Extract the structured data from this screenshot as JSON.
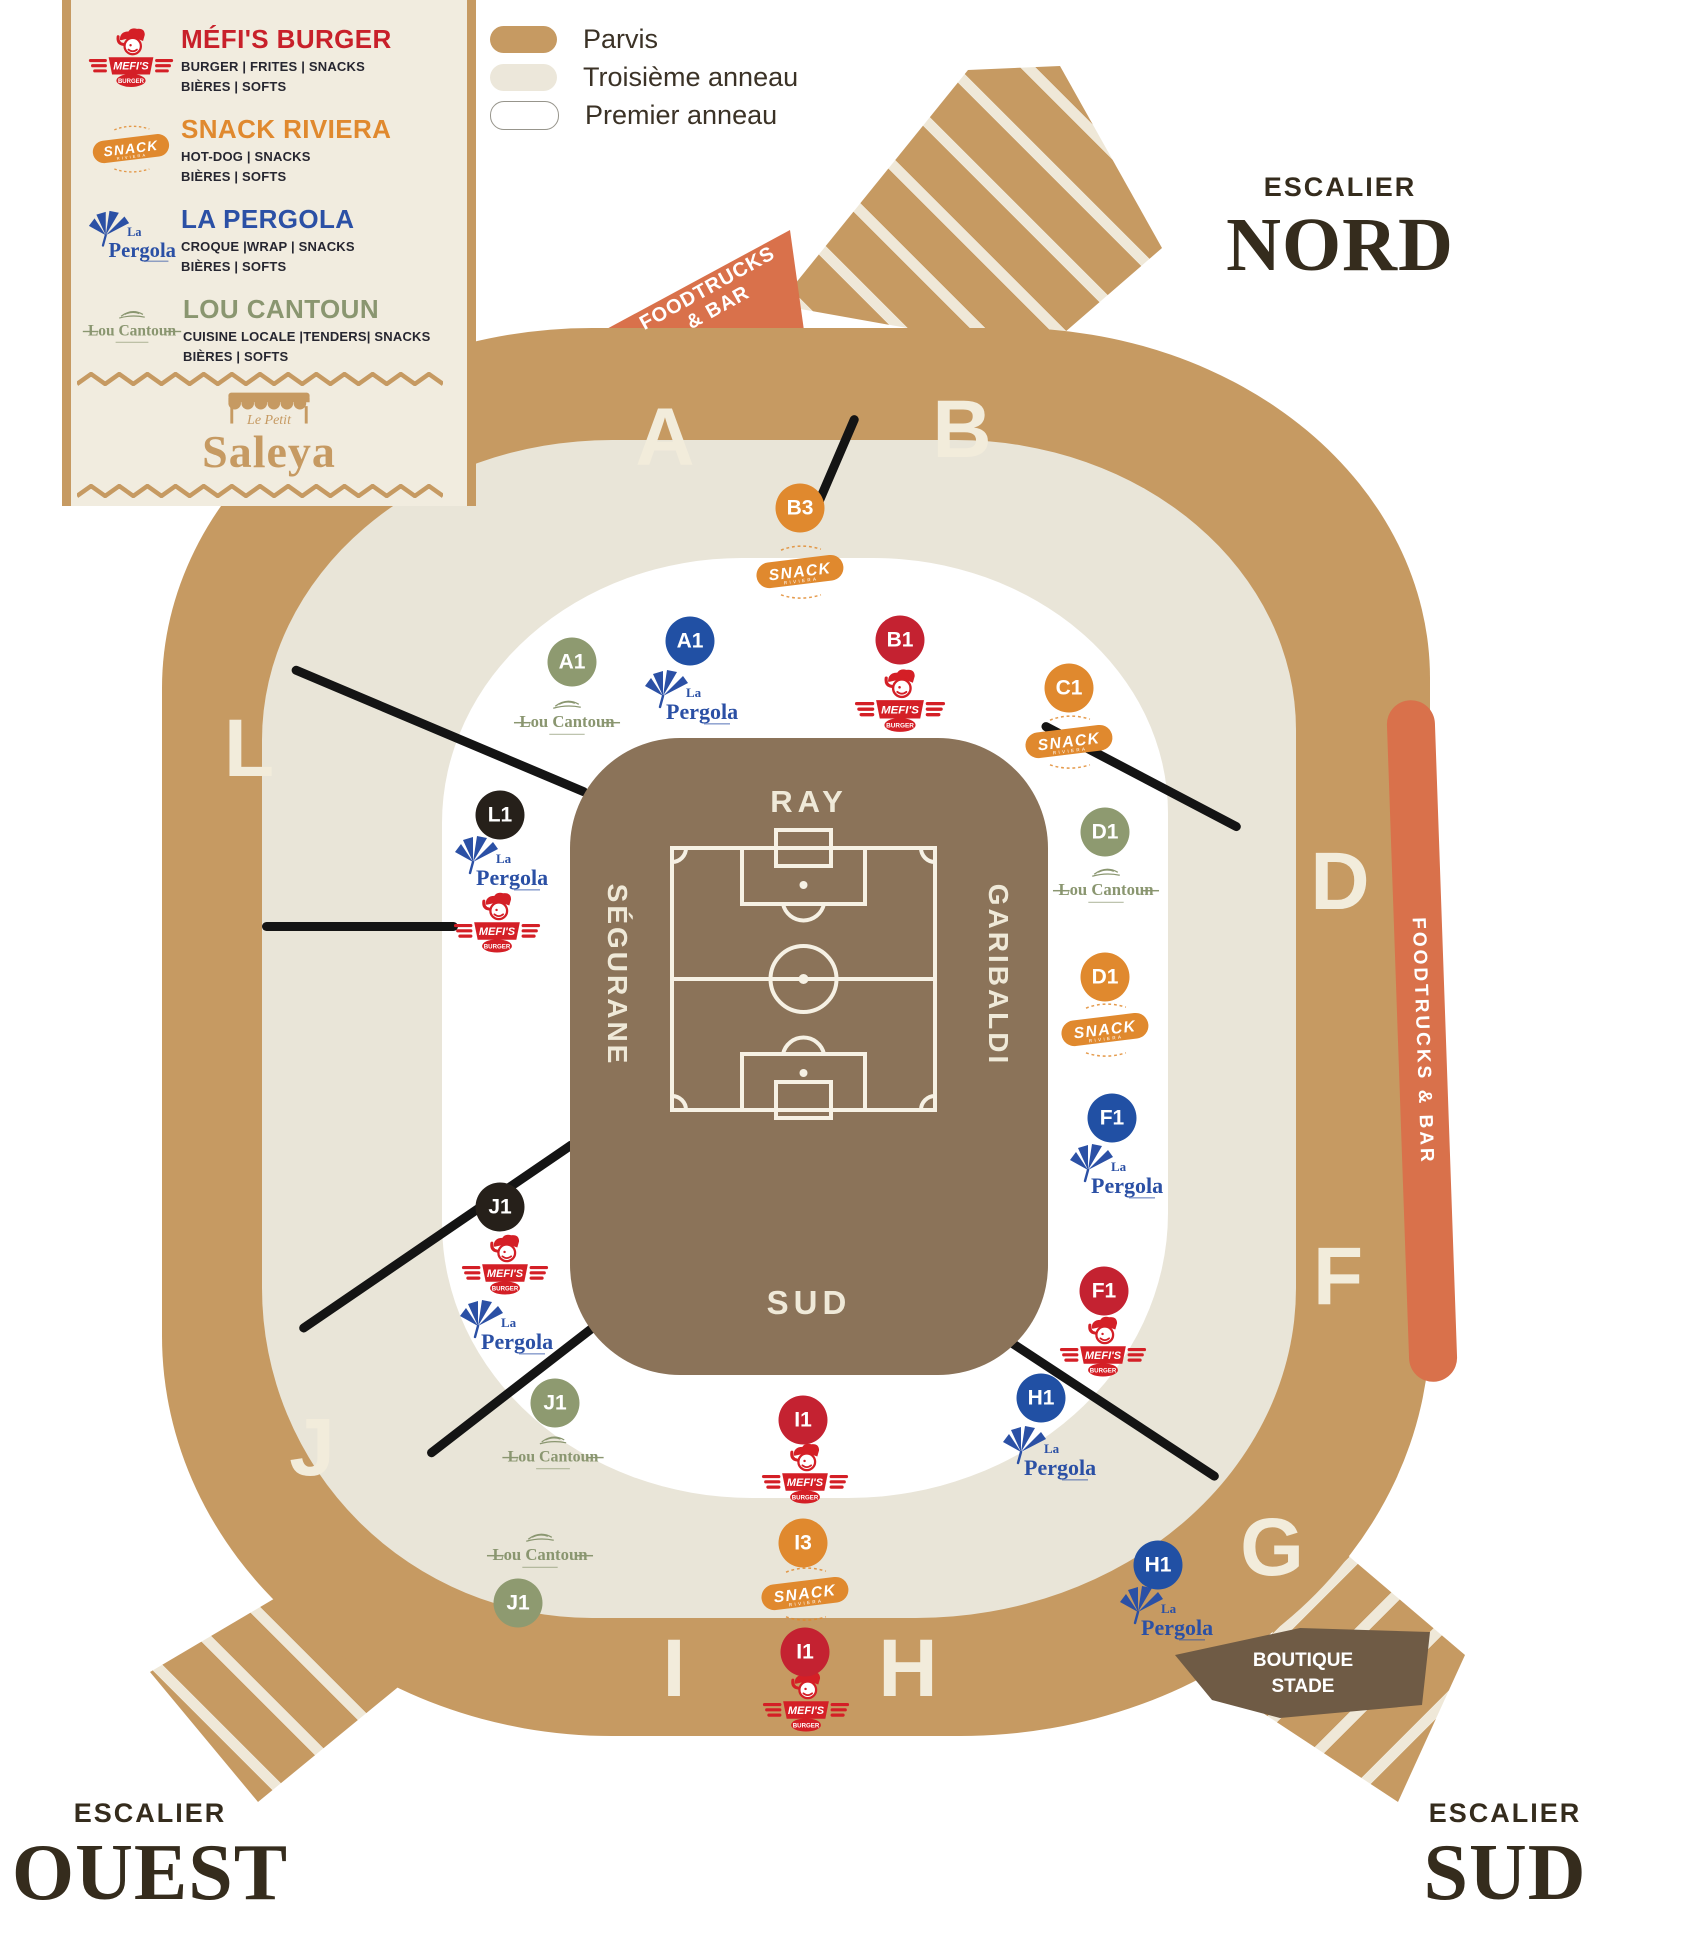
{
  "legend": {
    "vendors": [
      {
        "id": "mefis",
        "name": "MÉFI'S BURGER",
        "line1": "BURGER | FRITES | SNACKS",
        "line2": "BIÈRES | SOFTS",
        "color": "#c8202a"
      },
      {
        "id": "snack",
        "name": "SNACK RIVIERA",
        "line1": "HOT-DOG | SNACKS",
        "line2": "BIÈRES | SOFTS",
        "color": "#e0892e"
      },
      {
        "id": "pergola",
        "name": "LA PERGOLA",
        "line1": "CROQUE |WRAP | SNACKS",
        "line2": "BIÈRES | SOFTS",
        "color": "#2b50a5"
      },
      {
        "id": "loucantoun",
        "name": "LOU CANTOUN",
        "line1": "CUISINE LOCALE |TENDERS| SNACKS",
        "line2": "BIÈRES | SOFTS",
        "color": "#8a9670"
      }
    ],
    "saleya": {
      "top": "Le Petit",
      "name": "Saleya"
    }
  },
  "rings_legend": [
    {
      "label": "Parvis",
      "color": "#c69a62",
      "style": "solid"
    },
    {
      "label": "Troisième anneau",
      "color": "#ece7da",
      "style": "solid"
    },
    {
      "label": "Premier anneau",
      "color": "#ffffff",
      "style": "outline"
    }
  ],
  "escaliers": {
    "nord": {
      "small": "ESCALIER",
      "big": "NORD"
    },
    "ouest": {
      "small": "ESCALIER",
      "big": "OUEST"
    },
    "sud": {
      "small": "ESCALIER",
      "big": "SUD"
    }
  },
  "zones": {
    "foodtrucks_line1": "FOODTRUCKS",
    "foodtrucks_line2": "& BAR",
    "foodtrucks_right": "FOODTRUCKS & BAR",
    "boutique_line1": "BOUTIQUE",
    "boutique_line2": "STADE"
  },
  "stands": {
    "north": "RAY",
    "east": "GARIBALDI",
    "south": "SUD",
    "west": "SÉGURANE"
  },
  "brands": {
    "mefis": {
      "banner": "MEFI'S",
      "sub": "BURGER"
    },
    "snack": {
      "main": "SNACK",
      "sub": "RIVIERA"
    },
    "pergola": {
      "small": "La",
      "main": "Pergola"
    },
    "loucantoun": {
      "main": "Lou Cantoun"
    }
  },
  "sections": [
    {
      "label": "A",
      "x": 665,
      "y": 438
    },
    {
      "label": "B",
      "x": 962,
      "y": 430
    },
    {
      "label": "L",
      "x": 249,
      "y": 749
    },
    {
      "label": "D",
      "x": 1340,
      "y": 882
    },
    {
      "label": "F",
      "x": 1338,
      "y": 1277
    },
    {
      "label": "G",
      "x": 1272,
      "y": 1548
    },
    {
      "label": "J",
      "x": 312,
      "y": 1448
    },
    {
      "label": "I",
      "x": 674,
      "y": 1669
    },
    {
      "label": "H",
      "x": 908,
      "y": 1669
    }
  ],
  "markers": [
    {
      "label": "B3",
      "color": "orange",
      "x": 800,
      "y": 508
    },
    {
      "label": "A1",
      "color": "green",
      "x": 572,
      "y": 662
    },
    {
      "label": "A1",
      "color": "blue",
      "x": 690,
      "y": 641
    },
    {
      "label": "B1",
      "color": "red",
      "x": 900,
      "y": 640
    },
    {
      "label": "C1",
      "color": "orange",
      "x": 1069,
      "y": 688
    },
    {
      "label": "L1",
      "color": "black",
      "x": 500,
      "y": 815
    },
    {
      "label": "D1",
      "color": "green",
      "x": 1105,
      "y": 832
    },
    {
      "label": "D1",
      "color": "orange",
      "x": 1105,
      "y": 977
    },
    {
      "label": "F1",
      "color": "blue",
      "x": 1112,
      "y": 1118
    },
    {
      "label": "F1",
      "color": "red",
      "x": 1104,
      "y": 1291
    },
    {
      "label": "H1",
      "color": "blue",
      "x": 1041,
      "y": 1398
    },
    {
      "label": "J1",
      "color": "black",
      "x": 500,
      "y": 1207
    },
    {
      "label": "J1",
      "color": "green",
      "x": 555,
      "y": 1403
    },
    {
      "label": "J1",
      "color": "green",
      "x": 518,
      "y": 1603
    },
    {
      "label": "I1",
      "color": "red",
      "x": 803,
      "y": 1420
    },
    {
      "label": "I3",
      "color": "orange",
      "x": 803,
      "y": 1543
    },
    {
      "label": "I1",
      "color": "red",
      "x": 805,
      "y": 1652
    },
    {
      "label": "H1",
      "color": "blue",
      "x": 1158,
      "y": 1565
    }
  ],
  "logos": [
    {
      "brand": "snack",
      "x": 800,
      "y": 572,
      "w": 95
    },
    {
      "brand": "loucantoun",
      "x": 567,
      "y": 720,
      "w": 110
    },
    {
      "brand": "pergola",
      "x": 690,
      "y": 700,
      "w": 100
    },
    {
      "brand": "mefis",
      "x": 900,
      "y": 702,
      "w": 92
    },
    {
      "brand": "snack",
      "x": 1069,
      "y": 742,
      "w": 95
    },
    {
      "brand": "pergola",
      "x": 500,
      "y": 866,
      "w": 100
    },
    {
      "brand": "mefis",
      "x": 497,
      "y": 924,
      "w": 88
    },
    {
      "brand": "loucantoun",
      "x": 1106,
      "y": 888,
      "w": 110
    },
    {
      "brand": "snack",
      "x": 1105,
      "y": 1030,
      "w": 95
    },
    {
      "brand": "pergola",
      "x": 1115,
      "y": 1174,
      "w": 100
    },
    {
      "brand": "mefis",
      "x": 1103,
      "y": 1348,
      "w": 88
    },
    {
      "brand": "pergola",
      "x": 1048,
      "y": 1456,
      "w": 100
    },
    {
      "brand": "mefis",
      "x": 505,
      "y": 1266,
      "w": 88
    },
    {
      "brand": "pergola",
      "x": 505,
      "y": 1330,
      "w": 100
    },
    {
      "brand": "loucantoun",
      "x": 553,
      "y": 1455,
      "w": 105
    },
    {
      "brand": "loucantoun",
      "x": 540,
      "y": 1553,
      "w": 110
    },
    {
      "brand": "mefis",
      "x": 805,
      "y": 1475,
      "w": 88
    },
    {
      "brand": "snack",
      "x": 805,
      "y": 1594,
      "w": 95
    },
    {
      "brand": "mefis",
      "x": 806,
      "y": 1703,
      "w": 88
    },
    {
      "brand": "pergola",
      "x": 1165,
      "y": 1616,
      "w": 100
    }
  ],
  "lines": [
    {
      "x1": 292,
      "y1": 668,
      "x2": 588,
      "y2": 793
    },
    {
      "x1": 262,
      "y1": 926,
      "x2": 458,
      "y2": 926
    },
    {
      "x1": 300,
      "y1": 1330,
      "x2": 575,
      "y2": 1142
    },
    {
      "x1": 428,
      "y1": 1455,
      "x2": 615,
      "y2": 1310
    },
    {
      "x1": 856,
      "y1": 415,
      "x2": 810,
      "y2": 522
    },
    {
      "x1": 1042,
      "y1": 724,
      "x2": 1240,
      "y2": 828
    },
    {
      "x1": 1005,
      "y1": 1338,
      "x2": 1218,
      "y2": 1478
    }
  ],
  "palette": {
    "tan": "#c69a62",
    "cream": "#e9e5d8",
    "white_ring": "#ffffff",
    "field": "#8b7359",
    "boutique": "#6f5b45",
    "orange_zone": "#d9714b",
    "text_dark": "#352c1d",
    "badges": {
      "red": "#c42231",
      "orange": "#e0892e",
      "blue": "#2150a4",
      "green": "#8e9a70",
      "black": "#26201a"
    }
  }
}
